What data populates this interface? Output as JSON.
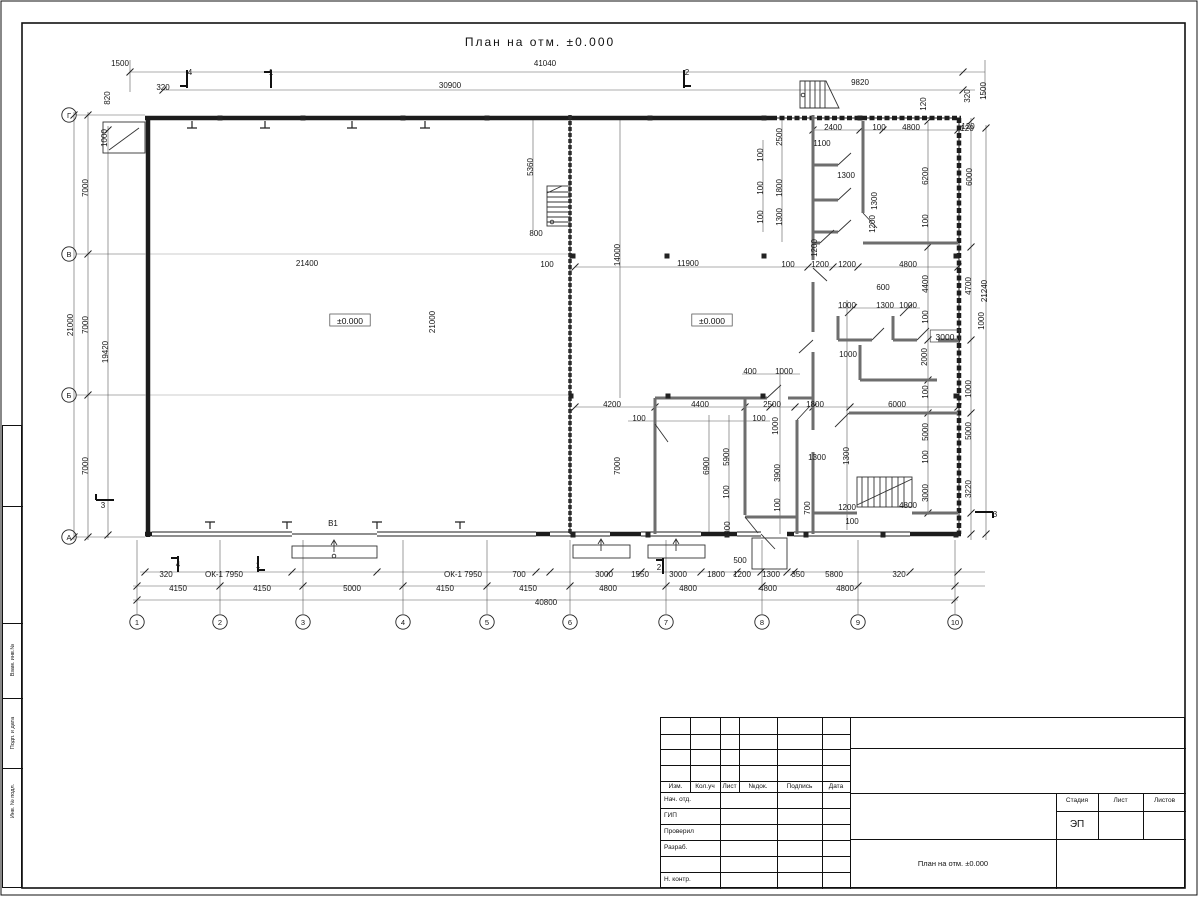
{
  "title": "План на отм. ±0.000",
  "grid_axes": {
    "columns": [
      "1",
      "2",
      "3",
      "4",
      "5",
      "6",
      "7",
      "8",
      "9",
      "10"
    ],
    "rows": [
      "Г",
      "В",
      "Б",
      "А"
    ]
  },
  "boxed_labels": [
    {
      "t": "±0.000",
      "x": 350,
      "y": 322
    },
    {
      "t": "±0.000",
      "x": 712,
      "y": 322
    },
    {
      "t": "3000",
      "x": 945,
      "y": 338
    }
  ],
  "dim_labels": [
    [
      "1500",
      120,
      66,
      0
    ],
    [
      "41040",
      545,
      66,
      0
    ],
    [
      "320",
      163,
      90,
      0
    ],
    [
      "30900",
      450,
      88,
      0
    ],
    [
      "9820",
      860,
      85,
      0
    ],
    [
      "820",
      110,
      98,
      1
    ],
    [
      "1000",
      107,
      138,
      1
    ],
    [
      "120",
      926,
      104,
      1
    ],
    [
      "320",
      970,
      96,
      1
    ],
    [
      "1500",
      986,
      91,
      1
    ],
    [
      "4",
      190,
      75,
      0
    ],
    [
      "1",
      271,
      75,
      0
    ],
    [
      "2",
      687,
      75,
      0
    ],
    [
      "7000",
      88,
      188,
      1
    ],
    [
      "7000",
      88,
      325,
      1
    ],
    [
      "7000",
      88,
      466,
      1
    ],
    [
      "21000",
      73,
      325,
      1
    ],
    [
      "19420",
      108,
      352,
      1
    ],
    [
      "3",
      103,
      508,
      0
    ],
    [
      "120",
      968,
      129,
      0
    ],
    [
      "6000",
      972,
      177,
      1
    ],
    [
      "4700",
      971,
      286,
      1
    ],
    [
      "21240",
      987,
      291,
      1
    ],
    [
      "1000",
      984,
      321,
      1
    ],
    [
      "1000",
      971,
      389,
      1
    ],
    [
      "5000",
      971,
      431,
      1
    ],
    [
      "3220",
      971,
      489,
      1
    ],
    [
      "3",
      995,
      517,
      0
    ],
    [
      "320",
      166,
      577,
      0
    ],
    [
      "ОК-1 7950",
      224,
      577,
      0
    ],
    [
      "ОК-1 7950",
      463,
      577,
      0
    ],
    [
      "700",
      519,
      577,
      0
    ],
    [
      "3000",
      604,
      577,
      0
    ],
    [
      "1550",
      640,
      577,
      0
    ],
    [
      "3000",
      678,
      577,
      0
    ],
    [
      "1800",
      716,
      577,
      0
    ],
    [
      "1200",
      742,
      577,
      0
    ],
    [
      "500",
      740,
      563,
      0
    ],
    [
      "1300",
      771,
      577,
      0
    ],
    [
      "350",
      798,
      577,
      0
    ],
    [
      "5800",
      834,
      577,
      0
    ],
    [
      "320",
      899,
      577,
      0
    ],
    [
      "4150",
      178,
      591,
      0
    ],
    [
      "4150",
      262,
      591,
      0
    ],
    [
      "5000",
      352,
      591,
      0
    ],
    [
      "4150",
      445,
      591,
      0
    ],
    [
      "4150",
      528,
      591,
      0
    ],
    [
      "4800",
      608,
      591,
      0
    ],
    [
      "4800",
      688,
      591,
      0
    ],
    [
      "4800",
      768,
      591,
      0
    ],
    [
      "4800",
      845,
      591,
      0
    ],
    [
      "40800",
      546,
      605,
      0
    ],
    [
      "В1",
      333,
      526,
      0
    ],
    [
      "4",
      178,
      567,
      0
    ],
    [
      "1",
      258,
      568,
      0
    ],
    [
      "2",
      659,
      570,
      0
    ],
    [
      "21400",
      307,
      266,
      0
    ],
    [
      "21000",
      435,
      322,
      1
    ],
    [
      "5360",
      533,
      167,
      1
    ],
    [
      "800",
      536,
      236,
      0
    ],
    [
      "100",
      547,
      267,
      0
    ],
    [
      "14000",
      620,
      255,
      1
    ],
    [
      "11900",
      688,
      266,
      0
    ],
    [
      "2500",
      782,
      137,
      1
    ],
    [
      "2400",
      833,
      130,
      0
    ],
    [
      "100",
      879,
      130,
      0
    ],
    [
      "4800",
      911,
      130,
      0
    ],
    [
      "120",
      967,
      131,
      0
    ],
    [
      "1100",
      822,
      146,
      0
    ],
    [
      "1300",
      846,
      178,
      0
    ],
    [
      "6200",
      928,
      176,
      1
    ],
    [
      "100",
      763,
      155,
      1
    ],
    [
      "100",
      763,
      188,
      1
    ],
    [
      "1800",
      782,
      188,
      1
    ],
    [
      "100",
      763,
      217,
      1
    ],
    [
      "1300",
      782,
      217,
      1
    ],
    [
      "1300",
      877,
      201,
      1
    ],
    [
      "1200",
      875,
      224,
      1
    ],
    [
      "100",
      928,
      221,
      1
    ],
    [
      "1200",
      817,
      248,
      1
    ],
    [
      "100",
      788,
      267,
      0
    ],
    [
      "1200",
      820,
      267,
      0
    ],
    [
      "1200",
      847,
      267,
      0
    ],
    [
      "4800",
      908,
      267,
      0
    ],
    [
      "600",
      883,
      290,
      0
    ],
    [
      "1000",
      847,
      308,
      0
    ],
    [
      "1300",
      885,
      308,
      0
    ],
    [
      "1000",
      908,
      308,
      0
    ],
    [
      "100",
      928,
      317,
      1
    ],
    [
      "4400",
      928,
      284,
      1
    ],
    [
      "2000",
      927,
      357,
      1
    ],
    [
      "1000",
      848,
      357,
      0
    ],
    [
      "400",
      750,
      374,
      0
    ],
    [
      "1000",
      784,
      374,
      0
    ],
    [
      "4200",
      612,
      407,
      0
    ],
    [
      "4400",
      700,
      407,
      0
    ],
    [
      "2500",
      772,
      407,
      0
    ],
    [
      "1800",
      815,
      407,
      0
    ],
    [
      "6000",
      897,
      407,
      0
    ],
    [
      "100",
      639,
      421,
      0
    ],
    [
      "100",
      759,
      421,
      0
    ],
    [
      "1000",
      778,
      426,
      1
    ],
    [
      "7000",
      620,
      466,
      1
    ],
    [
      "6900",
      709,
      466,
      1
    ],
    [
      "5900",
      729,
      457,
      1
    ],
    [
      "100",
      729,
      492,
      1
    ],
    [
      "900",
      730,
      528,
      1
    ],
    [
      "3900",
      780,
      473,
      1
    ],
    [
      "100",
      780,
      505,
      1
    ],
    [
      "1300",
      817,
      460,
      0
    ],
    [
      "1300",
      849,
      456,
      1
    ],
    [
      "700",
      810,
      508,
      1
    ],
    [
      "1200",
      847,
      510,
      0
    ],
    [
      "100",
      852,
      524,
      0
    ],
    [
      "100",
      928,
      392,
      1
    ],
    [
      "5000",
      928,
      432,
      1
    ],
    [
      "100",
      928,
      457,
      1
    ],
    [
      "3000",
      928,
      493,
      1
    ],
    [
      "4800",
      908,
      508,
      0
    ]
  ],
  "stamp": {
    "header_cols": [
      "Изм.",
      "Кол.уч",
      "Лист",
      "№док.",
      "Подпись",
      "Дата"
    ],
    "rows": [
      "Нач. отд.",
      "ГИП",
      "Проверил",
      "Разраб.",
      "",
      "Н. контр."
    ],
    "doc_title": "План на отм. ±0.000",
    "stage_header": "Стадия",
    "sheet_header": "Лист",
    "sheets_header": "Листов",
    "stage_value": "ЭП"
  },
  "side_strip": [
    "Взам. инв.№",
    "Подп. и дата",
    "Инв. № подл."
  ]
}
